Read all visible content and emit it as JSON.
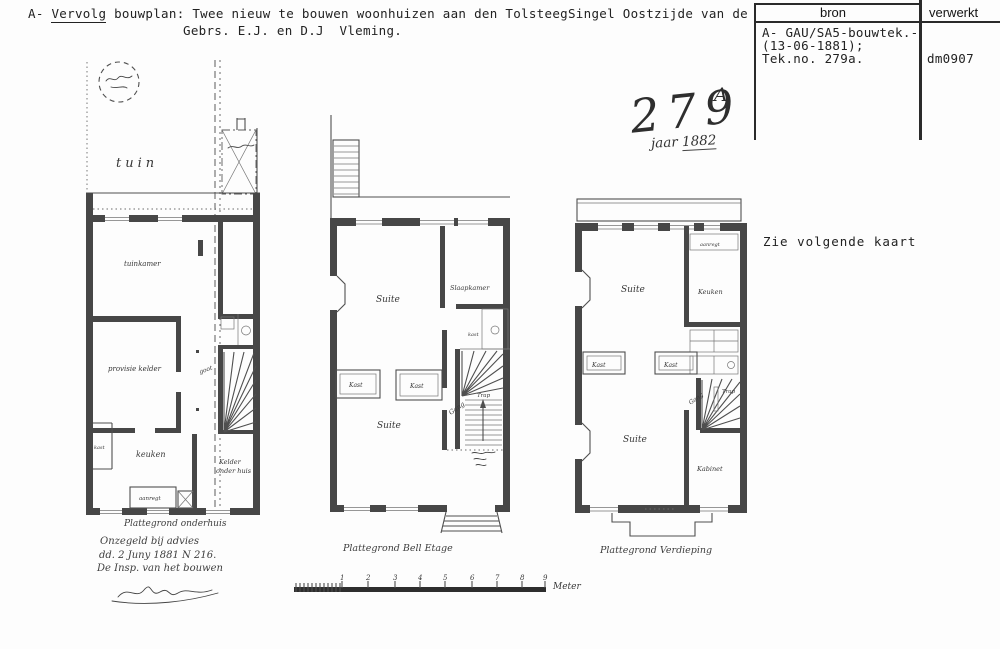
{
  "header": {
    "prefix": "A-",
    "keyword": "Vervolg",
    "title_rest": "bouwplan: Twee nieuw te bouwen woonhuizen aan den TolsteegSingel Oostzijde van de",
    "title_line2": "Gebrs. E.J. en D.J  Vleming."
  },
  "index_table": {
    "col_bron": "bron",
    "col_verwerkt": "verwerkt",
    "bron_line1": "A- GAU/SA5-bouwtek.-",
    "bron_line2": "(13-06-1881);",
    "bron_line3": "Tek.no. 279a.",
    "verwerkt_value": "dm0907"
  },
  "stamp": {
    "number": "279",
    "suffix": "A",
    "year_word": "jaar ",
    "year_value": "1882"
  },
  "note_right": "Zie volgende kaart",
  "plans": {
    "left": {
      "garden": "tuin",
      "room_top": "tuinkamer",
      "room_mid": "provisie kelder",
      "gutter": "goot",
      "kitchen": "keuken",
      "cellar_line1": "Kelder",
      "cellar_line2": "onder huis",
      "counter": "aanregt",
      "closet": "kast"
    },
    "middle": {
      "caption": "Plattegrond Bell Etage",
      "suite": "Suite",
      "back_room": "Slaapkamer",
      "closet": "Kast",
      "stairs": "Trap",
      "hall": "Gang",
      "privy": "kast"
    },
    "right": {
      "caption": "Plattegrond Verdieping",
      "suite": "Suite",
      "kitchen": "Keuken",
      "counter": "aanregt",
      "closet": "Kast",
      "stairs": "Trap",
      "hall": "Gang",
      "cabinet": "Kabinet"
    }
  },
  "annotation": {
    "line1": "Plattegrond onderhuis",
    "line2": "Onzegeld bij advies",
    "line3": "dd. 2 Juny 1881 N 216.",
    "line4": "De Insp. van het bouwen"
  },
  "scale": {
    "ticks": [
      "1",
      "2",
      "3",
      "4",
      "5",
      "6",
      "7",
      "8",
      "9"
    ],
    "unit": "Meter"
  }
}
